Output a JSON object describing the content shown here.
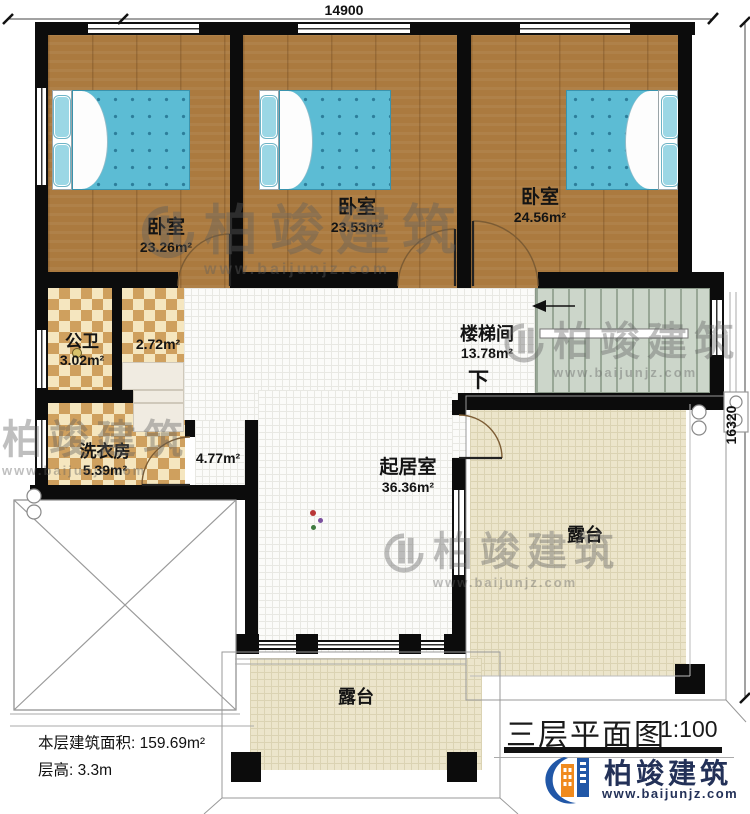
{
  "plan": {
    "dim_top": "14900",
    "dim_right": "16320",
    "stairs_down_label": "下",
    "info_area_label": "本层建筑面积: 159.69m²",
    "info_height_label": "层高: 3.3m",
    "title": "三层平面图",
    "scale": "1:100"
  },
  "rooms": {
    "bedroom1": {
      "name": "卧室",
      "area": "23.26m²"
    },
    "bedroom2": {
      "name": "卧室",
      "area": "23.53m²"
    },
    "bedroom3": {
      "name": "卧室",
      "area": "24.56m²"
    },
    "bathroom": {
      "name": "公卫",
      "area": "3.02m²"
    },
    "vanity": {
      "area": "2.72m²"
    },
    "laundry": {
      "name": "洗衣房",
      "area": "5.39m²"
    },
    "corridor": {
      "area": "4.77m²"
    },
    "stairwell": {
      "name": "楼梯间",
      "area": "13.78m²"
    },
    "living": {
      "name": "起居室",
      "area": "36.36m²"
    },
    "terrace_right": {
      "name": "露台"
    },
    "terrace_bottom": {
      "name": "露台"
    }
  },
  "brand": {
    "name": "柏竣建筑",
    "url": "www.baijunjz.com"
  },
  "watermark": {
    "name": "柏竣建筑",
    "url": "www.baijunjz.com"
  },
  "colors": {
    "brand_blue": "#2157a7",
    "brand_orange": "#f08a1d",
    "wall": "#0c0c0c",
    "wood_floor": "#ab7a3f",
    "mattress_blue": "#58b7d0",
    "checker_tan": "#cfa05e",
    "terrace_beige": "#ece5cb"
  }
}
